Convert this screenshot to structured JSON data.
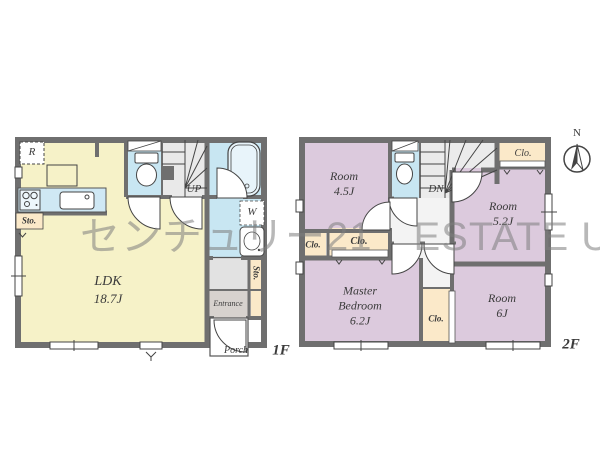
{
  "watermark": "センチュリー21　ESTATE UP",
  "colors": {
    "wall": "#6f6f6f",
    "ldk_yellow": "#f6f2c8",
    "wet_blue": "#c8e6f2",
    "bedroom_purple": "#dccadd",
    "closet_cream": "#fbe9c9",
    "stair_gray": "#e9e9e9",
    "entrance_gray": "#d7d2ce",
    "watermark_gray": "#7d7d7d"
  },
  "floor1": {
    "floor_label": "1F",
    "ldk_name": "LDK",
    "ldk_size": "18.7J",
    "stairs_label": "UP",
    "fridge_label": "R",
    "washer_label": "W",
    "storage_kitchen": "Sto.",
    "storage_hall": "Sto.",
    "entrance_label": "Entrance",
    "porch_label": "Porch"
  },
  "floor2": {
    "floor_label": "2F",
    "room_a_name": "Room",
    "room_a_size": "4.5J",
    "room_b_name": "Room",
    "room_b_size": "5.2J",
    "room_c_name": "Room",
    "room_c_size": "6J",
    "master_name_1": "Master",
    "master_name_2": "Bedroom",
    "master_size": "6.2J",
    "stairs_label": "DN",
    "closet_top": "Clo.",
    "closet_small": "Clo.",
    "closet_wide": "Clo.",
    "closet_mid": "Clo.",
    "compass_north": "N"
  }
}
